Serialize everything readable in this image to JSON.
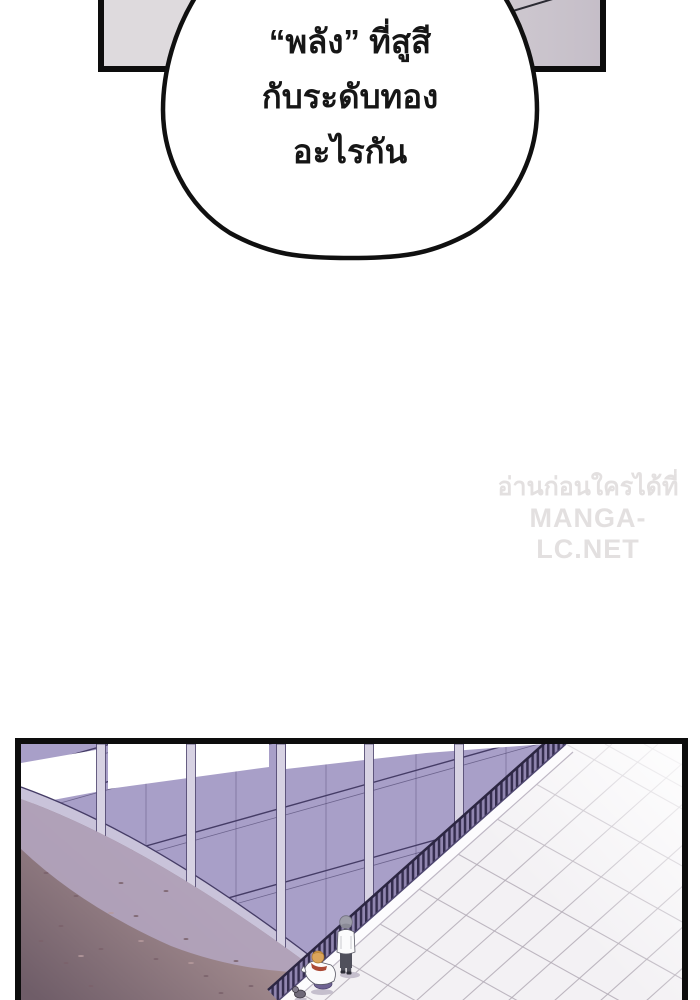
{
  "speech_bubble": {
    "lines": [
      "“พลัง” ที่สูสี",
      "กับระดับทอง",
      "อะไรกัน"
    ]
  },
  "watermark": {
    "line1": "อ่านก่อนใครได้ที่",
    "line2": "MANGA-LC.NET"
  },
  "theme": {
    "panel_border": "#0d0d0d",
    "bubble_border": "#101010",
    "bubble_fill": "#ffffff",
    "text": "#161616",
    "watermark": "#e3e0e0",
    "ceiling_left": "#dedadd",
    "ceiling_right": "#c5bec8",
    "wall": "#a89fc8",
    "seam": "#453c66",
    "pillar": "#d7d2e3",
    "band": "#c9c3da",
    "floor": "#f3f1f4",
    "tile": "#b3acb6",
    "ground_top": "#a78f92",
    "ground_bottom": "#6f5d68",
    "ground_shadow": "#b2a4be",
    "fence_dark": "#342d4e",
    "fence_light": "#9186b0",
    "curb": "#fcfbfd",
    "obj_shadow": "#c5bfcd",
    "standing_hair": "#9d9da9",
    "standing_top": "#fbfbfc",
    "standing_pants": "#50505c",
    "crouching_hair": "#dba45b",
    "crouching_collar": "#ab4a36",
    "crouching_pants": "#6e6292"
  }
}
